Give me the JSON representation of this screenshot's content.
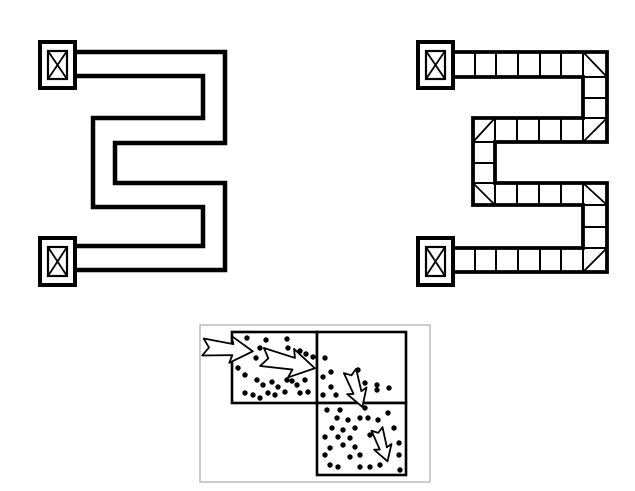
{
  "canvas": {
    "width": 635,
    "height": 491,
    "background": "#ffffff",
    "ink": "#000000"
  },
  "figures": {
    "continuous_corridor": {
      "role": "s-shaped-corridor-map-continuous",
      "outer_wall": "M 75 52 H 225 V 143 H 115 V 183 H 225 V 270 H 75",
      "inner_wall": "M 75 76 H 203 V 118 H 93 V 207 H 203 V 246 H 75",
      "wall_stroke": 4.5,
      "box_outer_stroke": 4,
      "box_inner_stroke": 2.2,
      "x_stroke": 1.8,
      "endpoint_boxes": [
        {
          "x": 40,
          "y": 42,
          "w": 35,
          "h": 46
        },
        {
          "x": 40,
          "y": 238,
          "w": 35,
          "h": 47
        }
      ]
    },
    "discretized_corridor": {
      "role": "s-shaped-corridor-map-discretized-into-cells",
      "outer_wall": "M 453 52 H 607 V 142 H 495 V 183 H 607 V 272 H 453",
      "inner_wall": "M 453 77 H 583 V 118 H 473 V 205 H 583 V 248 H 453",
      "wall_stroke": 3.8,
      "grid_stroke": 2,
      "diagonal_stroke": 1.8,
      "box_outer_stroke": 4,
      "box_inner_stroke": 2.2,
      "x_stroke": 1.8,
      "endpoint_boxes": [
        {
          "x": 418,
          "y": 42,
          "w": 35,
          "h": 46
        },
        {
          "x": 418,
          "y": 238,
          "w": 35,
          "h": 47
        }
      ],
      "grid_segments": [
        [
          475,
          52,
          475,
          77
        ],
        [
          496,
          52,
          496,
          77
        ],
        [
          518,
          52,
          518,
          77
        ],
        [
          540,
          52,
          540,
          77
        ],
        [
          561,
          52,
          561,
          77
        ],
        [
          583,
          52,
          583,
          77
        ],
        [
          583,
          77,
          607,
          77
        ],
        [
          583,
          98,
          607,
          98
        ],
        [
          583,
          118,
          607,
          118
        ],
        [
          495,
          118,
          495,
          142
        ],
        [
          517,
          118,
          517,
          142
        ],
        [
          539,
          118,
          539,
          142
        ],
        [
          561,
          118,
          561,
          142
        ],
        [
          583,
          118,
          583,
          142
        ],
        [
          473,
          142,
          495,
          142
        ],
        [
          473,
          163,
          495,
          163
        ],
        [
          473,
          183,
          495,
          183
        ],
        [
          495,
          183,
          495,
          205
        ],
        [
          517,
          183,
          517,
          205
        ],
        [
          539,
          183,
          539,
          205
        ],
        [
          561,
          183,
          561,
          205
        ],
        [
          583,
          183,
          583,
          205
        ],
        [
          583,
          205,
          607,
          205
        ],
        [
          583,
          227,
          607,
          227
        ],
        [
          583,
          248,
          607,
          248
        ],
        [
          475,
          248,
          475,
          272
        ],
        [
          496,
          248,
          496,
          272
        ],
        [
          518,
          248,
          518,
          272
        ],
        [
          540,
          248,
          540,
          272
        ],
        [
          561,
          248,
          561,
          272
        ],
        [
          583,
          248,
          583,
          272
        ]
      ],
      "corner_diagonals": [
        [
          583,
          52,
          607,
          77
        ],
        [
          583,
          142,
          607,
          118
        ],
        [
          473,
          142,
          495,
          118
        ],
        [
          473,
          183,
          495,
          205
        ],
        [
          583,
          183,
          607,
          205
        ],
        [
          583,
          272,
          607,
          248
        ]
      ]
    },
    "cell_flow": {
      "role": "detail-of-agent-flow-between-three-cells",
      "frame": {
        "x": 200,
        "y": 325,
        "w": 230,
        "h": 157,
        "stroke": "#b0b0b0",
        "stroke_width": 1.3
      },
      "cell_stroke": 2.6,
      "cell_fill": "#ffffff",
      "cells": [
        {
          "x": 232,
          "y": 332,
          "w": 85,
          "h": 71
        },
        {
          "x": 317,
          "y": 332,
          "w": 89,
          "h": 71
        },
        {
          "x": 317,
          "y": 403,
          "w": 89,
          "h": 72
        }
      ],
      "dot_radius": 2.7,
      "dots_upper_left": [
        [
          247,
          338
        ],
        [
          266,
          340
        ],
        [
          287,
          339
        ],
        [
          260,
          348
        ],
        [
          288,
          348
        ],
        [
          300,
          351
        ],
        [
          306,
          354
        ],
        [
          313,
          357
        ],
        [
          256,
          358
        ],
        [
          238,
          368
        ],
        [
          245,
          375
        ],
        [
          257,
          380
        ],
        [
          263,
          385
        ],
        [
          272,
          382
        ],
        [
          278,
          387
        ],
        [
          287,
          380
        ],
        [
          292,
          381
        ],
        [
          297,
          385
        ],
        [
          305,
          380
        ],
        [
          245,
          393
        ],
        [
          253,
          395
        ],
        [
          260,
          398
        ],
        [
          268,
          393
        ],
        [
          275,
          395
        ],
        [
          285,
          392
        ],
        [
          300,
          393
        ],
        [
          308,
          392
        ]
      ],
      "dots_upper_right": [
        [
          325,
          358
        ],
        [
          331,
          372
        ],
        [
          323,
          377
        ],
        [
          331,
          387
        ],
        [
          323,
          395
        ],
        [
          336,
          395
        ],
        [
          358,
          370
        ],
        [
          365,
          383
        ],
        [
          377,
          385
        ],
        [
          377,
          390
        ],
        [
          389,
          388
        ]
      ],
      "dots_lower_right": [
        [
          327,
          410
        ],
        [
          340,
          410
        ],
        [
          365,
          408
        ],
        [
          388,
          413
        ],
        [
          337,
          418
        ],
        [
          348,
          420
        ],
        [
          360,
          418
        ],
        [
          368,
          418
        ],
        [
          378,
          420
        ],
        [
          332,
          428
        ],
        [
          343,
          430
        ],
        [
          355,
          428
        ],
        [
          394,
          428
        ],
        [
          325,
          437
        ],
        [
          338,
          437
        ],
        [
          350,
          438
        ],
        [
          370,
          435
        ],
        [
          343,
          445
        ],
        [
          355,
          447
        ],
        [
          330,
          448
        ],
        [
          399,
          443
        ],
        [
          325,
          455
        ],
        [
          350,
          457
        ],
        [
          360,
          455
        ],
        [
          399,
          455
        ],
        [
          330,
          465
        ],
        [
          338,
          467
        ],
        [
          360,
          467
        ],
        [
          370,
          467
        ],
        [
          380,
          465
        ],
        [
          400,
          470
        ]
      ],
      "arrow_fill": "#ffffff",
      "arrow_stroke": 1.8,
      "arrow_shape": [
        [
          0,
          -0.17
        ],
        [
          0.12,
          0
        ],
        [
          0,
          0.17
        ],
        [
          0.6,
          0.11
        ],
        [
          0.55,
          0.27
        ],
        [
          1,
          0
        ],
        [
          0.55,
          -0.27
        ],
        [
          0.6,
          -0.11
        ]
      ],
      "arrows": [
        {
          "x": 203,
          "y": 347,
          "angle": 5,
          "size": 50,
          "name": "inflow-arrow"
        },
        {
          "x": 262,
          "y": 357,
          "angle": 12,
          "size": 54,
          "name": "transfer-arrow-right"
        },
        {
          "x": 350,
          "y": 371,
          "angle": 71,
          "size": 38,
          "name": "transfer-arrow-down"
        },
        {
          "x": 377,
          "y": 429,
          "angle": 72,
          "size": 34,
          "name": "outflow-arrow"
        }
      ]
    }
  }
}
